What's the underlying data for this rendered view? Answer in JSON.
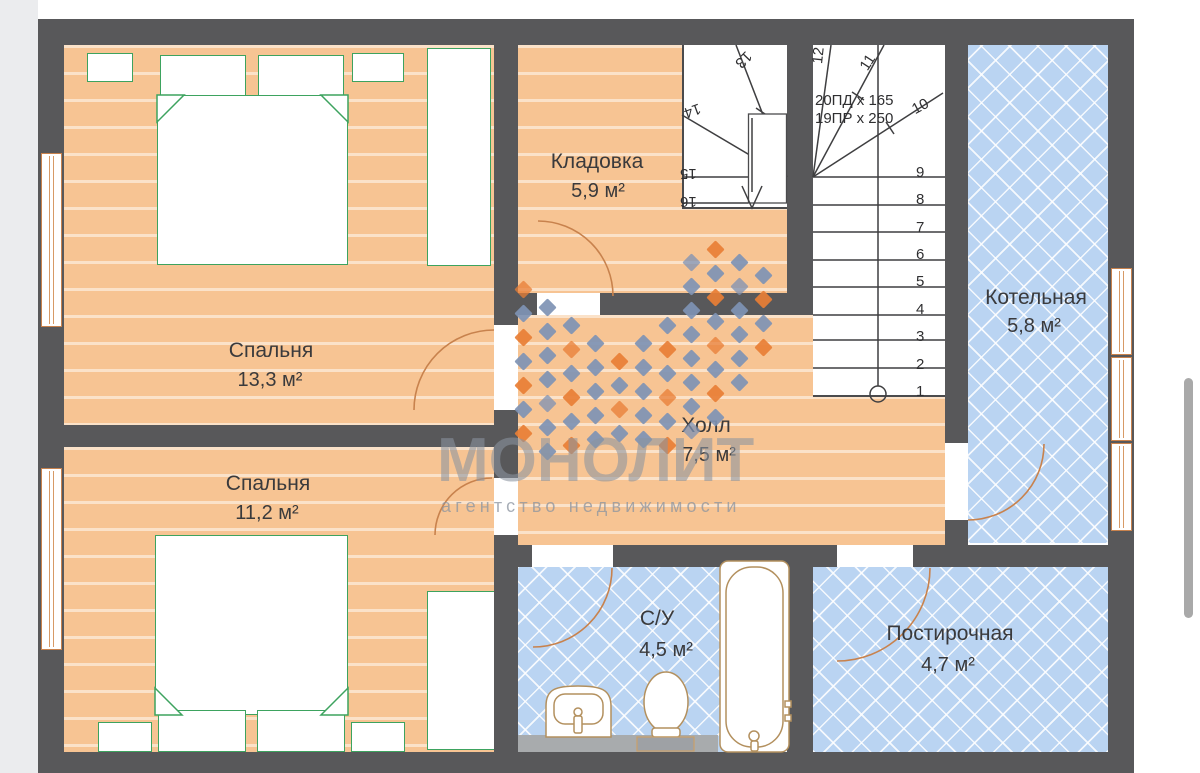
{
  "plan": {
    "rooms": {
      "bedroom1": {
        "name": "Спальня",
        "area": "13,3 м²"
      },
      "bedroom2": {
        "name": "Спальня",
        "area": "11,2 м²"
      },
      "storage": {
        "name": "Кладовка",
        "area": "5,9 м²"
      },
      "hall": {
        "name": "Холл",
        "area": "7,5 м²"
      },
      "boiler": {
        "name": "Котельная",
        "area": "5,8 м²"
      },
      "bathroom": {
        "name": "С/У",
        "area": "4,5 м²"
      },
      "laundry": {
        "name": "Постирочная",
        "area": "4,7 м²"
      }
    },
    "stairs": {
      "spec_line1": "20ПД x 165",
      "spec_line2": "19ПР x 250",
      "flight_numbers": [
        "1",
        "2",
        "3",
        "4",
        "5",
        "6",
        "7",
        "8",
        "9"
      ],
      "winder_numbers_right": [
        "10",
        "11",
        "12"
      ],
      "winder_numbers_left": [
        "13",
        "14",
        "15",
        "16"
      ]
    }
  },
  "watermark": {
    "brand": "МОНОЛИТ",
    "tagline": "агентство недвижимости"
  },
  "colors": {
    "wall": "#58585a",
    "wood_floor": "#f7c493",
    "tile_floor": "#bad4f2",
    "furniture": "#3da35f",
    "door_arc": "#c8824d",
    "stair_line": "#3f3f41",
    "logo_orange": "#e87e35",
    "logo_blue": "#7e92b4",
    "watermark_gray": "#8b94a0"
  }
}
